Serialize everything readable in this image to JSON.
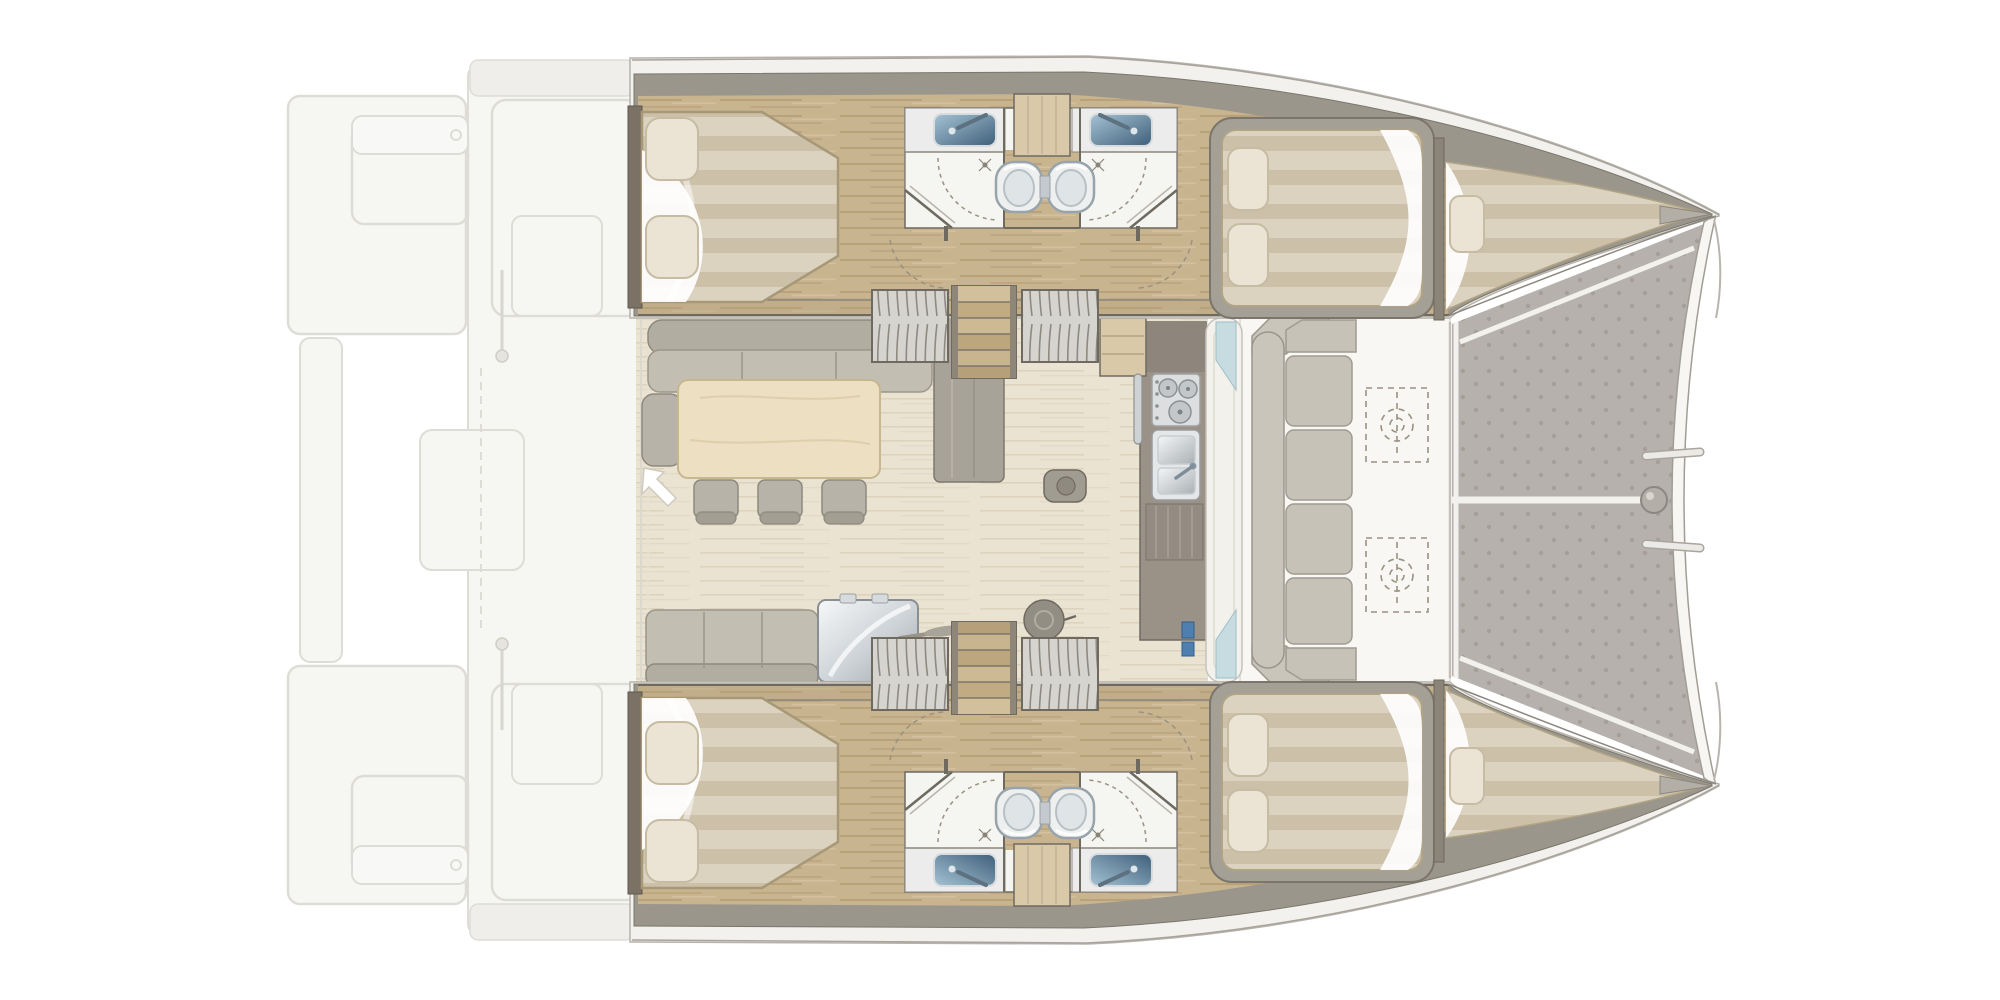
{
  "diagram": {
    "label": "Catamaran yacht interior layout plan, overhead view",
    "type": "boat-floor-plan",
    "orientation": "bow-right-stern-left"
  },
  "palette": {
    "white": "#ffffff",
    "wall": "#9b968b",
    "rim": "#f2f1ed",
    "wood": "#c9b490",
    "wood_dark": "#a98f63",
    "wood_light": "#d9c9a8",
    "salon": "#eae3d2",
    "salon_streak": "#d9cfb8",
    "matt": "#dcd2c0",
    "matt_stripe": "#cdc0a9",
    "pillow": "#ebe3d3",
    "pillow_edge": "#c6bba3",
    "frame": "#a5a095",
    "bath": "#f4f4f1",
    "counter": "#ebeceb",
    "sink1": "#a6c3d4",
    "sink2": "#3e5f7a",
    "toilet": "#eef0f0",
    "toilet_line": "#98a4ab",
    "sofa": "#b2ada1",
    "sofa_seat": "#c3beb2",
    "table": "#ecdfc2",
    "table_edge": "#c7b78f",
    "chair": "#b8b3a8",
    "galley": "#9a9187",
    "steel1": "#f4f6f7",
    "steel2": "#aab0b4",
    "deck": "#f8f7f4",
    "cushion": "#c6c2b7",
    "cushion_edge": "#9f9b90",
    "tramp": "#b6b1ac",
    "tramp_dot": "#a49f99",
    "beam": "#f7f6f2",
    "outline": "#6f6a60",
    "ghost": "#f6f6f3",
    "ghost_line": "#dedcd6",
    "glass": "#c7dce0",
    "blue": "#4f7fae",
    "dash": "#9a9181"
  },
  "components": {
    "aft_deck": [
      "swim-platform-port",
      "swim-platform-starboard",
      "aft-cockpit-ghost",
      "davit-rods",
      "engine-hatch"
    ],
    "port_hull": [
      "aft-double-bed",
      "vanity-sink-left",
      "vanity-sink-right",
      "shower-left",
      "shower-right",
      "toilet-left",
      "toilet-right",
      "louvered-locker-left",
      "staircase",
      "louvered-locker-right",
      "forward-double-bed",
      "forepeak-berth"
    ],
    "starboard_hull": "mirror-of-port-hull",
    "salon": [
      "u-sofa",
      "dining-table",
      "chairs-x3",
      "side-seat",
      "entry-arrow",
      "lounge-bench",
      "icebox",
      "stool-small",
      "stool-large",
      "galley-cooktop",
      "galley-sink",
      "nav-boxes"
    ],
    "forward_cockpit": [
      "bench-back",
      "bench-cushions-x4",
      "table-mount-x2"
    ],
    "foredeck": [
      "trampoline",
      "bow-crossbeam",
      "beam-fitting",
      "lacing-rods-x2"
    ]
  },
  "counts": {
    "cabins": 4,
    "berths": 6,
    "bathrooms": 4,
    "toilets": 4,
    "sinks": 4,
    "showers": 4,
    "dining_chairs": 3
  }
}
